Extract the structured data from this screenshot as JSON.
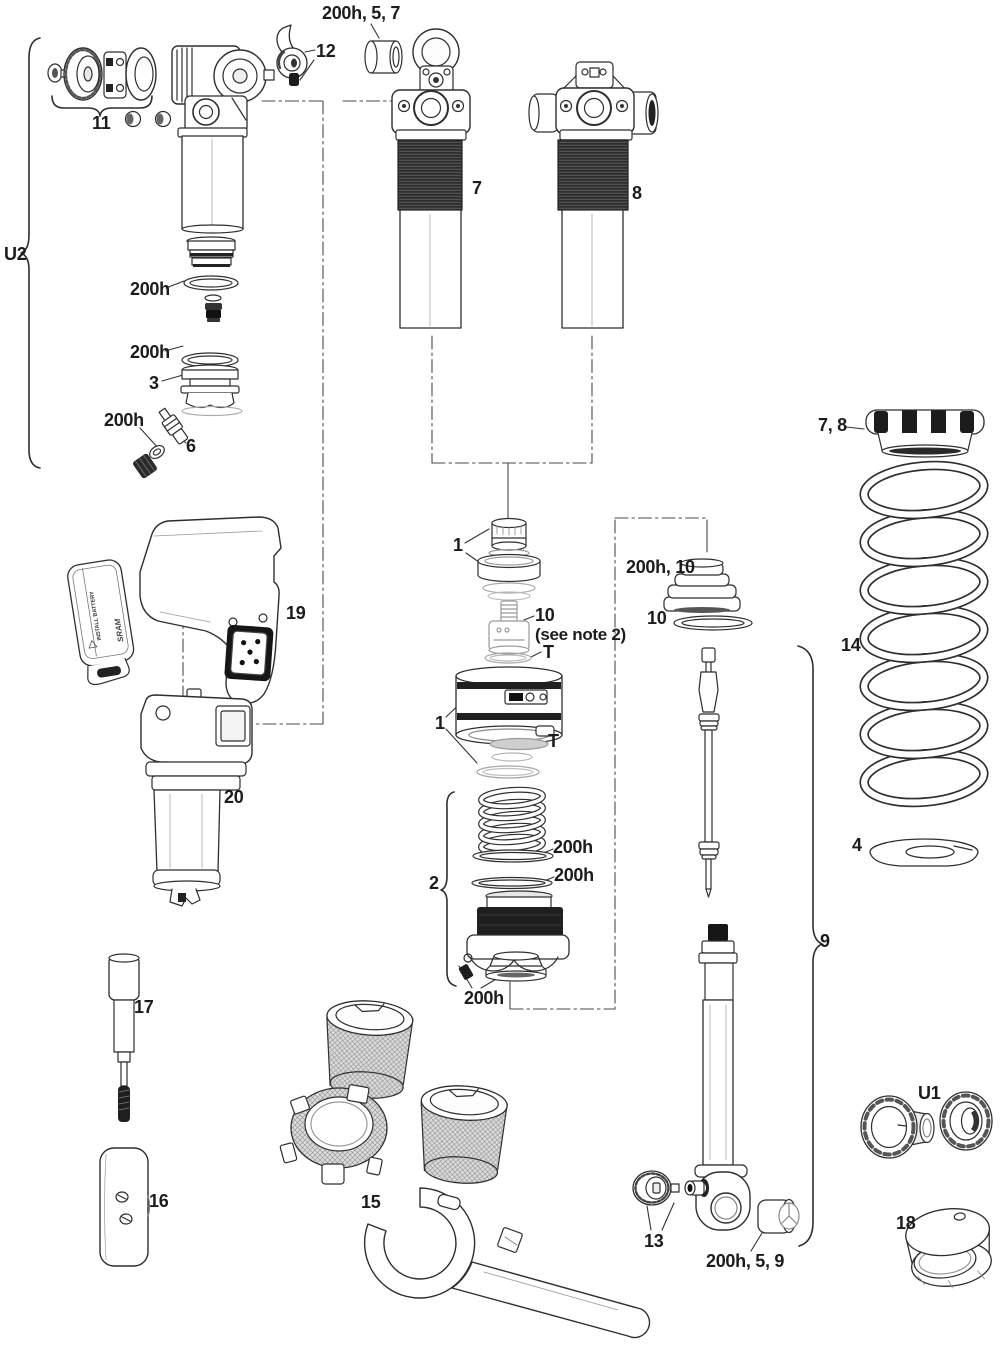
{
  "figure": {
    "description": "Rear shock exploded parts diagram",
    "colors": {
      "line": "#2e2e2e",
      "dark_fill": "#1f1f1f",
      "background": "#ffffff"
    }
  },
  "battery": {
    "brand": "SRAM",
    "instruction": "INSTALL BATTERY"
  },
  "callouts": {
    "c200h_5_7": {
      "text": "200h, 5, 7"
    },
    "c12": {
      "text": "12"
    },
    "c11": {
      "text": "11"
    },
    "u2": {
      "text": "U2"
    },
    "c200h_a": {
      "text": "200h"
    },
    "c200h_b": {
      "text": "200h"
    },
    "c3": {
      "text": "3"
    },
    "c200h_c": {
      "text": "200h"
    },
    "c6": {
      "text": "6"
    },
    "c7": {
      "text": "7"
    },
    "c8": {
      "text": "8"
    },
    "c7_8": {
      "text": "7, 8"
    },
    "c14": {
      "text": "14"
    },
    "c4": {
      "text": "4"
    },
    "c1_top": {
      "text": "1"
    },
    "c10_mid": {
      "text": "10"
    },
    "note2": {
      "text": "(see note 2)"
    },
    "t_top": {
      "text": "T"
    },
    "c1_low": {
      "text": "1"
    },
    "t_low": {
      "text": "T"
    },
    "c200h_10": {
      "text": "200h, 10"
    },
    "c10_right": {
      "text": "10"
    },
    "c2": {
      "text": "2"
    },
    "c200h_d": {
      "text": "200h"
    },
    "c200h_e": {
      "text": "200h"
    },
    "c200h_f": {
      "text": "200h"
    },
    "c19": {
      "text": "19"
    },
    "c20": {
      "text": "20"
    },
    "c9": {
      "text": "9"
    },
    "c17": {
      "text": "17"
    },
    "c16": {
      "text": "16"
    },
    "c15": {
      "text": "15"
    },
    "c13": {
      "text": "13"
    },
    "c200h_5_9": {
      "text": "200h, 5, 9"
    },
    "u1": {
      "text": "U1"
    },
    "c18": {
      "text": "18"
    }
  }
}
